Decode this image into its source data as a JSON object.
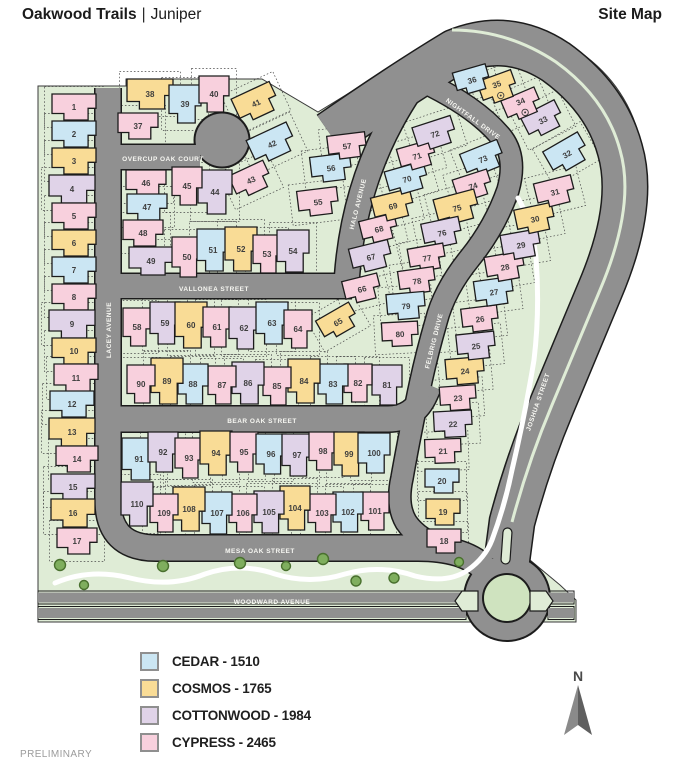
{
  "header": {
    "title_primary": "Oakwood Trails",
    "title_separator": "|",
    "title_secondary": "Juniper",
    "doc_label": "Site Map"
  },
  "footer": {
    "preliminary": "PRELIMINARY"
  },
  "compass": {
    "label": "N"
  },
  "palette": {
    "green": "#dfecd6",
    "road": "#909090",
    "road_casing": "#1c1c1c",
    "tree": "#7fae5e",
    "tree_edge": "#49702e",
    "path": "#ffffff",
    "street_text": "#f7f7f2",
    "lot_text": "#3d3d3d"
  },
  "legend": {
    "items": [
      {
        "model": "CE",
        "label": "CEDAR - 1510"
      },
      {
        "model": "CO",
        "label": "COSMOS - 1765"
      },
      {
        "model": "CW",
        "label": "COTTONWOOD - 1984"
      },
      {
        "model": "CY",
        "label": "CYPRESS - 2465"
      }
    ]
  },
  "map": {
    "models": {
      "CE": {
        "name": "CEDAR",
        "color": "#cbe6f3"
      },
      "CO": {
        "name": "COSMOS",
        "color": "#f9dc96"
      },
      "CW": {
        "name": "COTTONWOOD",
        "color": "#e0d3e8"
      },
      "CY": {
        "name": "CYPRESS",
        "color": "#f8d0dd"
      }
    },
    "streets": [
      {
        "name": "OVERCUP OAK COURT",
        "x": 163,
        "y": 159,
        "r": 0
      },
      {
        "name": "VALLONEA STREET",
        "x": 214,
        "y": 289,
        "r": 0
      },
      {
        "name": "BEAR OAK STREET",
        "x": 262,
        "y": 421,
        "r": 0
      },
      {
        "name": "MESA OAK STREET",
        "x": 260,
        "y": 551,
        "r": 0
      },
      {
        "name": "WOODWARD AVENUE",
        "x": 272,
        "y": 602,
        "r": 0
      },
      {
        "name": "LACEY AVENUE",
        "x": 109,
        "y": 330,
        "r": -90
      },
      {
        "name": "HALO AVENUE",
        "x": 358,
        "y": 204,
        "r": -76
      },
      {
        "name": "NIGHTFALL DRIVE",
        "x": 473,
        "y": 119,
        "r": 36
      },
      {
        "name": "FELBRIG DRIVE",
        "x": 434,
        "y": 341,
        "r": -76
      },
      {
        "name": "JOSHUA STREET",
        "x": 538,
        "y": 402,
        "r": -71
      }
    ],
    "lots": [
      {
        "n": 1,
        "m": "CY",
        "x": 74,
        "y": 107,
        "w": 44,
        "h": 26,
        "r": 0
      },
      {
        "n": 2,
        "m": "CE",
        "x": 74,
        "y": 134,
        "w": 44,
        "h": 26,
        "r": 0
      },
      {
        "n": 3,
        "m": "CO",
        "x": 74,
        "y": 161,
        "w": 44,
        "h": 26,
        "r": 0
      },
      {
        "n": 4,
        "m": "CW",
        "x": 72,
        "y": 189,
        "w": 46,
        "h": 28,
        "r": 0
      },
      {
        "n": 5,
        "m": "CY",
        "x": 74,
        "y": 216,
        "w": 44,
        "h": 26,
        "r": 0
      },
      {
        "n": 6,
        "m": "CO",
        "x": 74,
        "y": 243,
        "w": 44,
        "h": 26,
        "r": 0
      },
      {
        "n": 7,
        "m": "CE",
        "x": 74,
        "y": 270,
        "w": 44,
        "h": 26,
        "r": 0
      },
      {
        "n": 8,
        "m": "CY",
        "x": 74,
        "y": 297,
        "w": 44,
        "h": 26,
        "r": 0
      },
      {
        "n": 9,
        "m": "CW",
        "x": 72,
        "y": 324,
        "w": 46,
        "h": 28,
        "r": 0
      },
      {
        "n": 10,
        "m": "CO",
        "x": 74,
        "y": 351,
        "w": 44,
        "h": 26,
        "r": 0
      },
      {
        "n": 11,
        "m": "CY",
        "x": 76,
        "y": 378,
        "w": 44,
        "h": 28,
        "r": 0
      },
      {
        "n": 12,
        "m": "CE",
        "x": 72,
        "y": 404,
        "w": 44,
        "h": 26,
        "r": 0
      },
      {
        "n": 13,
        "m": "CO",
        "x": 72,
        "y": 432,
        "w": 46,
        "h": 28,
        "r": 0
      },
      {
        "n": 14,
        "m": "CY",
        "x": 77,
        "y": 459,
        "w": 42,
        "h": 26,
        "r": 0
      },
      {
        "n": 15,
        "m": "CW",
        "x": 73,
        "y": 487,
        "w": 44,
        "h": 26,
        "r": 0
      },
      {
        "n": 16,
        "m": "CO",
        "x": 73,
        "y": 513,
        "w": 44,
        "h": 28,
        "r": 0
      },
      {
        "n": 17,
        "m": "CY",
        "x": 77,
        "y": 541,
        "w": 40,
        "h": 26,
        "r": 0
      },
      {
        "n": 18,
        "m": "CY",
        "x": 444,
        "y": 541,
        "w": 34,
        "h": 24,
        "r": 0
      },
      {
        "n": 19,
        "m": "CO",
        "x": 443,
        "y": 512,
        "w": 34,
        "h": 26,
        "r": 0
      },
      {
        "n": 20,
        "m": "CE",
        "x": 442,
        "y": 481,
        "w": 34,
        "h": 24,
        "r": 0
      },
      {
        "n": 21,
        "m": "CY",
        "x": 443,
        "y": 451,
        "w": 36,
        "h": 24,
        "r": -2
      },
      {
        "n": 22,
        "m": "CW",
        "x": 453,
        "y": 424,
        "w": 38,
        "h": 26,
        "r": -3
      },
      {
        "n": 23,
        "m": "CY",
        "x": 458,
        "y": 398,
        "w": 36,
        "h": 24,
        "r": -4
      },
      {
        "n": 24,
        "m": "CO",
        "x": 465,
        "y": 371,
        "w": 38,
        "h": 26,
        "r": -5
      },
      {
        "n": 25,
        "m": "CW",
        "x": 476,
        "y": 346,
        "w": 38,
        "h": 26,
        "r": -6
      },
      {
        "n": 26,
        "m": "CY",
        "x": 480,
        "y": 319,
        "w": 36,
        "h": 24,
        "r": -7
      },
      {
        "n": 27,
        "m": "CE",
        "x": 494,
        "y": 292,
        "w": 38,
        "h": 26,
        "r": -8
      },
      {
        "n": 28,
        "m": "CY",
        "x": 505,
        "y": 267,
        "w": 38,
        "h": 26,
        "r": -10
      },
      {
        "n": 29,
        "m": "CW",
        "x": 521,
        "y": 245,
        "w": 38,
        "h": 26,
        "r": -10
      },
      {
        "n": 30,
        "m": "CO",
        "x": 535,
        "y": 219,
        "w": 38,
        "h": 26,
        "r": -12
      },
      {
        "n": 31,
        "m": "CY",
        "x": 555,
        "y": 192,
        "w": 38,
        "h": 26,
        "r": -14
      },
      {
        "n": 32,
        "m": "CE",
        "x": 567,
        "y": 154,
        "w": 40,
        "h": 28,
        "r": -30
      },
      {
        "n": 33,
        "m": "CW",
        "x": 543,
        "y": 120,
        "w": 38,
        "h": 26,
        "r": -27
      },
      {
        "n": 34,
        "m": "CY",
        "x": 522,
        "y": 105,
        "w": 36,
        "h": 24,
        "r": -23,
        "mk": true
      },
      {
        "n": 35,
        "m": "CO",
        "x": 498,
        "y": 88,
        "w": 36,
        "h": 26,
        "r": -20,
        "mk": true
      },
      {
        "n": 36,
        "m": "CE",
        "x": 472,
        "y": 80,
        "w": 34,
        "h": 24,
        "r": -16
      },
      {
        "n": 37,
        "m": "CY",
        "x": 138,
        "y": 126,
        "w": 40,
        "h": 26,
        "r": 0
      },
      {
        "n": 38,
        "m": "CO",
        "x": 150,
        "y": 94,
        "w": 46,
        "h": 30,
        "r": 0
      },
      {
        "n": 39,
        "m": "CE",
        "x": 185,
        "y": 104,
        "w": 32,
        "h": 38,
        "r": 0
      },
      {
        "n": 40,
        "m": "CY",
        "x": 214,
        "y": 94,
        "w": 30,
        "h": 36,
        "r": 0
      },
      {
        "n": 41,
        "m": "CO",
        "x": 256,
        "y": 103,
        "w": 42,
        "h": 28,
        "r": -25
      },
      {
        "n": 42,
        "m": "CE",
        "x": 272,
        "y": 144,
        "w": 44,
        "h": 28,
        "r": -25
      },
      {
        "n": 43,
        "m": "CY",
        "x": 251,
        "y": 180,
        "w": 38,
        "h": 26,
        "r": -25
      },
      {
        "n": 44,
        "m": "CW",
        "x": 215,
        "y": 192,
        "w": 34,
        "h": 44,
        "r": 0
      },
      {
        "n": 45,
        "m": "CY",
        "x": 187,
        "y": 186,
        "w": 30,
        "h": 38,
        "r": 0
      },
      {
        "n": 46,
        "m": "CY",
        "x": 146,
        "y": 183,
        "w": 40,
        "h": 26,
        "r": 0
      },
      {
        "n": 47,
        "m": "CE",
        "x": 147,
        "y": 207,
        "w": 40,
        "h": 26,
        "r": 0
      },
      {
        "n": 48,
        "m": "CY",
        "x": 143,
        "y": 233,
        "w": 40,
        "h": 26,
        "r": 0
      },
      {
        "n": 49,
        "m": "CW",
        "x": 151,
        "y": 261,
        "w": 44,
        "h": 28,
        "r": 0
      },
      {
        "n": 50,
        "m": "CY",
        "x": 187,
        "y": 257,
        "w": 30,
        "h": 40,
        "r": 0
      },
      {
        "n": 51,
        "m": "CE",
        "x": 213,
        "y": 250,
        "w": 32,
        "h": 42,
        "r": 0
      },
      {
        "n": 52,
        "m": "CO",
        "x": 241,
        "y": 249,
        "w": 32,
        "h": 44,
        "r": 0
      },
      {
        "n": 53,
        "m": "CY",
        "x": 267,
        "y": 254,
        "w": 28,
        "h": 38,
        "r": 0
      },
      {
        "n": 54,
        "m": "CW",
        "x": 293,
        "y": 251,
        "w": 32,
        "h": 42,
        "r": 0
      },
      {
        "n": 55,
        "m": "CY",
        "x": 318,
        "y": 202,
        "w": 40,
        "h": 26,
        "r": -7
      },
      {
        "n": 56,
        "m": "CE",
        "x": 331,
        "y": 168,
        "w": 40,
        "h": 26,
        "r": -7
      },
      {
        "n": 57,
        "m": "CY",
        "x": 347,
        "y": 146,
        "w": 38,
        "h": 24,
        "r": -7
      },
      {
        "n": 58,
        "m": "CY",
        "x": 137,
        "y": 327,
        "w": 28,
        "h": 38,
        "r": 0
      },
      {
        "n": 59,
        "m": "CW",
        "x": 165,
        "y": 323,
        "w": 30,
        "h": 42,
        "r": 0
      },
      {
        "n": 60,
        "m": "CO",
        "x": 191,
        "y": 325,
        "w": 32,
        "h": 46,
        "r": 0
      },
      {
        "n": 61,
        "m": "CY",
        "x": 217,
        "y": 327,
        "w": 28,
        "h": 40,
        "r": 0
      },
      {
        "n": 62,
        "m": "CW",
        "x": 244,
        "y": 328,
        "w": 30,
        "h": 42,
        "r": 0
      },
      {
        "n": 63,
        "m": "CE",
        "x": 272,
        "y": 323,
        "w": 32,
        "h": 42,
        "r": 0
      },
      {
        "n": 64,
        "m": "CY",
        "x": 298,
        "y": 329,
        "w": 28,
        "h": 38,
        "r": 0
      },
      {
        "n": 65,
        "m": "CO",
        "x": 338,
        "y": 322,
        "w": 38,
        "h": 24,
        "r": -30
      },
      {
        "n": 66,
        "m": "CY",
        "x": 362,
        "y": 289,
        "w": 36,
        "h": 24,
        "r": -14
      },
      {
        "n": 67,
        "m": "CW",
        "x": 371,
        "y": 257,
        "w": 40,
        "h": 26,
        "r": -14
      },
      {
        "n": 68,
        "m": "CY",
        "x": 379,
        "y": 229,
        "w": 36,
        "h": 24,
        "r": -14
      },
      {
        "n": 69,
        "m": "CO",
        "x": 393,
        "y": 206,
        "w": 40,
        "h": 26,
        "r": -14
      },
      {
        "n": 70,
        "m": "CE",
        "x": 407,
        "y": 179,
        "w": 40,
        "h": 26,
        "r": -16
      },
      {
        "n": 71,
        "m": "CY",
        "x": 417,
        "y": 156,
        "w": 36,
        "h": 24,
        "r": -16
      },
      {
        "n": 72,
        "m": "CW",
        "x": 435,
        "y": 134,
        "w": 40,
        "h": 26,
        "r": -18
      },
      {
        "n": 73,
        "m": "CE",
        "x": 483,
        "y": 159,
        "w": 40,
        "h": 26,
        "r": -22
      },
      {
        "n": 74,
        "m": "CY",
        "x": 473,
        "y": 186,
        "w": 36,
        "h": 24,
        "r": -18
      },
      {
        "n": 75,
        "m": "CO",
        "x": 457,
        "y": 208,
        "w": 42,
        "h": 28,
        "r": -15
      },
      {
        "n": 76,
        "m": "CW",
        "x": 442,
        "y": 233,
        "w": 38,
        "h": 26,
        "r": -12
      },
      {
        "n": 77,
        "m": "CY",
        "x": 427,
        "y": 258,
        "w": 36,
        "h": 24,
        "r": -10
      },
      {
        "n": 78,
        "m": "CY",
        "x": 417,
        "y": 281,
        "w": 36,
        "h": 24,
        "r": -8
      },
      {
        "n": 79,
        "m": "CE",
        "x": 406,
        "y": 306,
        "w": 38,
        "h": 26,
        "r": -5
      },
      {
        "n": 80,
        "m": "CY",
        "x": 400,
        "y": 334,
        "w": 36,
        "h": 24,
        "r": -3
      },
      {
        "n": 81,
        "m": "CW",
        "x": 387,
        "y": 385,
        "w": 30,
        "h": 40,
        "r": 0
      },
      {
        "n": 82,
        "m": "CY",
        "x": 358,
        "y": 383,
        "w": 28,
        "h": 38,
        "r": 0
      },
      {
        "n": 83,
        "m": "CE",
        "x": 333,
        "y": 384,
        "w": 30,
        "h": 40,
        "r": 0
      },
      {
        "n": 84,
        "m": "CO",
        "x": 304,
        "y": 381,
        "w": 32,
        "h": 44,
        "r": 0
      },
      {
        "n": 85,
        "m": "CY",
        "x": 277,
        "y": 386,
        "w": 28,
        "h": 38,
        "r": 0
      },
      {
        "n": 86,
        "m": "CW",
        "x": 248,
        "y": 383,
        "w": 32,
        "h": 42,
        "r": 0
      },
      {
        "n": 87,
        "m": "CY",
        "x": 222,
        "y": 385,
        "w": 28,
        "h": 38,
        "r": 0
      },
      {
        "n": 88,
        "m": "CE",
        "x": 193,
        "y": 384,
        "w": 30,
        "h": 40,
        "r": 0
      },
      {
        "n": 89,
        "m": "CO",
        "x": 167,
        "y": 381,
        "w": 32,
        "h": 46,
        "r": 0
      },
      {
        "n": 90,
        "m": "CY",
        "x": 141,
        "y": 384,
        "w": 28,
        "h": 38,
        "r": 0
      },
      {
        "n": 91,
        "m": "CE",
        "x": 139,
        "y": 459,
        "w": 34,
        "h": 42,
        "r": 0
      },
      {
        "n": 92,
        "m": "CW",
        "x": 163,
        "y": 452,
        "w": 30,
        "h": 40,
        "r": 0
      },
      {
        "n": 93,
        "m": "CY",
        "x": 189,
        "y": 458,
        "w": 28,
        "h": 40,
        "r": 0
      },
      {
        "n": 94,
        "m": "CO",
        "x": 216,
        "y": 453,
        "w": 32,
        "h": 44,
        "r": 0
      },
      {
        "n": 95,
        "m": "CY",
        "x": 244,
        "y": 452,
        "w": 28,
        "h": 40,
        "r": 0
      },
      {
        "n": 96,
        "m": "CE",
        "x": 271,
        "y": 454,
        "w": 30,
        "h": 40,
        "r": 0
      },
      {
        "n": 97,
        "m": "CW",
        "x": 297,
        "y": 455,
        "w": 30,
        "h": 42,
        "r": 0
      },
      {
        "n": 98,
        "m": "CY",
        "x": 323,
        "y": 451,
        "w": 28,
        "h": 38,
        "r": 0
      },
      {
        "n": 99,
        "m": "CO",
        "x": 349,
        "y": 454,
        "w": 30,
        "h": 44,
        "r": 0
      },
      {
        "n": 100,
        "m": "CE",
        "x": 374,
        "y": 453,
        "w": 32,
        "h": 40,
        "r": 0
      },
      {
        "n": 101,
        "m": "CY",
        "x": 375,
        "y": 511,
        "w": 28,
        "h": 38,
        "r": 0
      },
      {
        "n": 102,
        "m": "CE",
        "x": 348,
        "y": 512,
        "w": 30,
        "h": 40,
        "r": 0
      },
      {
        "n": 103,
        "m": "CY",
        "x": 322,
        "y": 513,
        "w": 28,
        "h": 38,
        "r": 0
      },
      {
        "n": 104,
        "m": "CO",
        "x": 295,
        "y": 508,
        "w": 30,
        "h": 44,
        "r": 0
      },
      {
        "n": 105,
        "m": "CW",
        "x": 269,
        "y": 512,
        "w": 30,
        "h": 42,
        "r": 0
      },
      {
        "n": 106,
        "m": "CY",
        "x": 243,
        "y": 513,
        "w": 28,
        "h": 38,
        "r": 0
      },
      {
        "n": 107,
        "m": "CE",
        "x": 217,
        "y": 513,
        "w": 30,
        "h": 42,
        "r": 0
      },
      {
        "n": 108,
        "m": "CO",
        "x": 189,
        "y": 509,
        "w": 32,
        "h": 44,
        "r": 0
      },
      {
        "n": 109,
        "m": "CY",
        "x": 164,
        "y": 513,
        "w": 28,
        "h": 38,
        "r": 0
      },
      {
        "n": 110,
        "m": "CW",
        "x": 137,
        "y": 504,
        "w": 32,
        "h": 44,
        "r": 0
      }
    ]
  }
}
